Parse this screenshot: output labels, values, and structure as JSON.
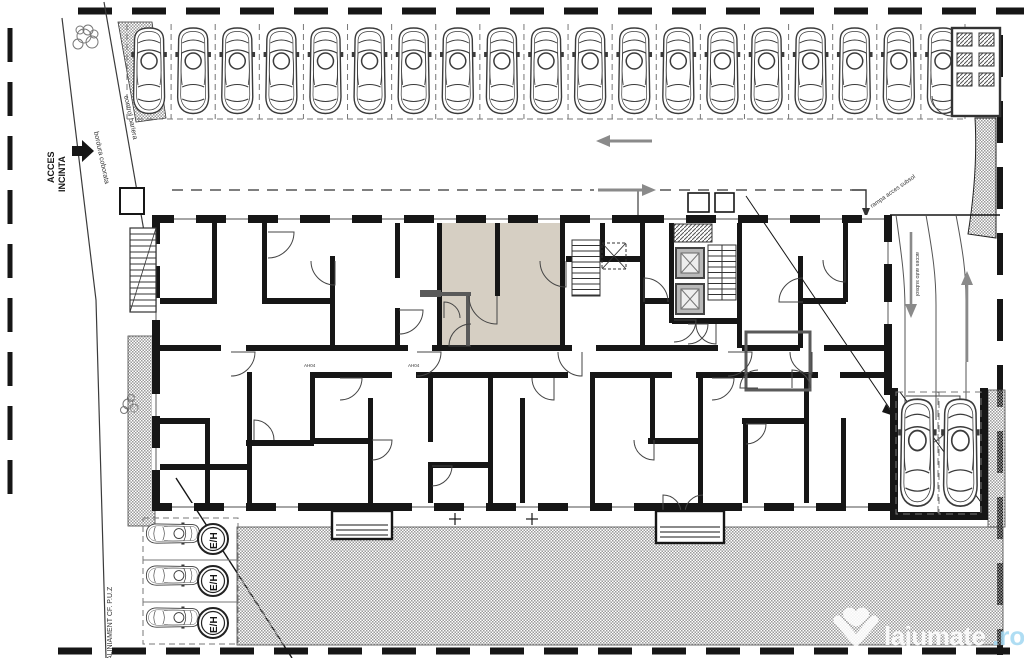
{
  "plan": {
    "labels": {
      "access_gate": "ACCES",
      "access_gate2": "INCINTA",
      "curb": "bordura coborata",
      "barrier_control": "control bariera",
      "alignment": "ALINIAMENT CF. P.U.Z",
      "ramp_note": "rampa acces subsol",
      "ramp_note2": "acces auto subsol",
      "ev_spot": "E/H",
      "door_tag": "AH04"
    },
    "counts": {
      "street_parking": 19,
      "ev_parking": 3,
      "garage_parking": 2,
      "elevators": 2
    },
    "colors": {
      "walls": "#161616",
      "thin_line": "#3b3b3b",
      "highlight_unit": "#d6cfc3",
      "arrows": "#8a8a8a",
      "hatch_dot": "#9a9a9a",
      "gray_wall": "#5a5a5a",
      "watermark_accent": "#a5d9f2"
    },
    "watermark": {
      "brand": "lajumate",
      "tld": ".ro"
    }
  }
}
